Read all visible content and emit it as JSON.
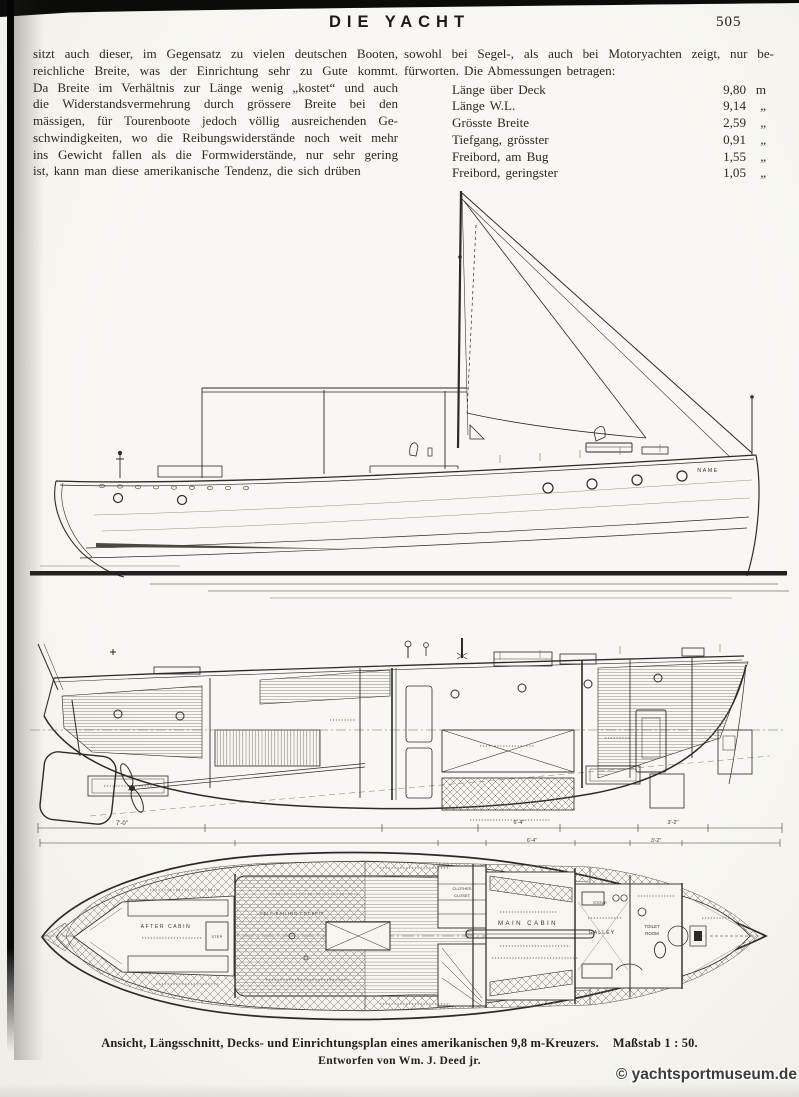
{
  "header": {
    "title": "DIE YACHT",
    "page_number": "505"
  },
  "article": {
    "left_lines": [
      "sitzt auch dieser, im Gegensatz zu vielen deutschen Booten,",
      "reichliche Breite, was der Einrichtung sehr zu Gute kommt.",
      "Da Breite im Verhältnis zur Länge wenig „kostet“ und auch",
      "die Widerstandsvermehrung durch grössere Breite bei den",
      "mässigen, für Tourenboote jedoch völlig ausreichenden Ge-",
      "schwindigkeiten, wo die Reibungswiderstände noch weit mehr",
      "ins Gewicht fallen als die Formwiderstände, nur sehr gering",
      "ist, kann man diese amerikanische Tendenz, die sich drüben"
    ],
    "right_lines": [
      "sowohl bei Segel-, als auch bei Motoryachten zeigt, nur be-",
      "fürworten.  Die Abmessungen betragen:"
    ],
    "dimensions": [
      {
        "label": "Länge über Deck",
        "value": "9,80",
        "unit": "m"
      },
      {
        "label": "Länge W.L.",
        "value": "9,14",
        "unit": "„"
      },
      {
        "label": "Grösste Breite",
        "value": "2,59",
        "unit": "„"
      },
      {
        "label": "Tiefgang, grösster",
        "value": "0,91",
        "unit": "„"
      },
      {
        "label": "Freibord, am Bug",
        "value": "1,55",
        "unit": "„"
      },
      {
        "label": "Freibord, geringster",
        "value": "1,05",
        "unit": "„"
      }
    ]
  },
  "figure": {
    "elevation": {
      "hull_name": "NAME"
    },
    "section": {
      "dims": [
        "7'-0''",
        "6'-4''",
        "3'-2''"
      ]
    },
    "plan": {
      "after_cabin": "AFTER CABIN",
      "self_bailing": "SELF-BAILING COCKPIT",
      "step": "STEP",
      "main_cabin": "MAIN CABIN",
      "galley": "GALLEY",
      "stove": "STOVE",
      "toilet_line1": "TOILET",
      "toilet_line2": "ROOM",
      "closet_line1": "CLOTHES",
      "closet_line2": "CLOSET"
    },
    "caption": {
      "line1": "Ansicht, Längsschnitt, Decks- und Einrichtungsplan eines amerikanischen 9,8 m-Kreuzers.",
      "scale": "Maßstab 1 : 50.",
      "line2": "Entworfen von Wm. J. Deed jr."
    }
  },
  "watermark": "© yachtsportmuseum.de"
}
